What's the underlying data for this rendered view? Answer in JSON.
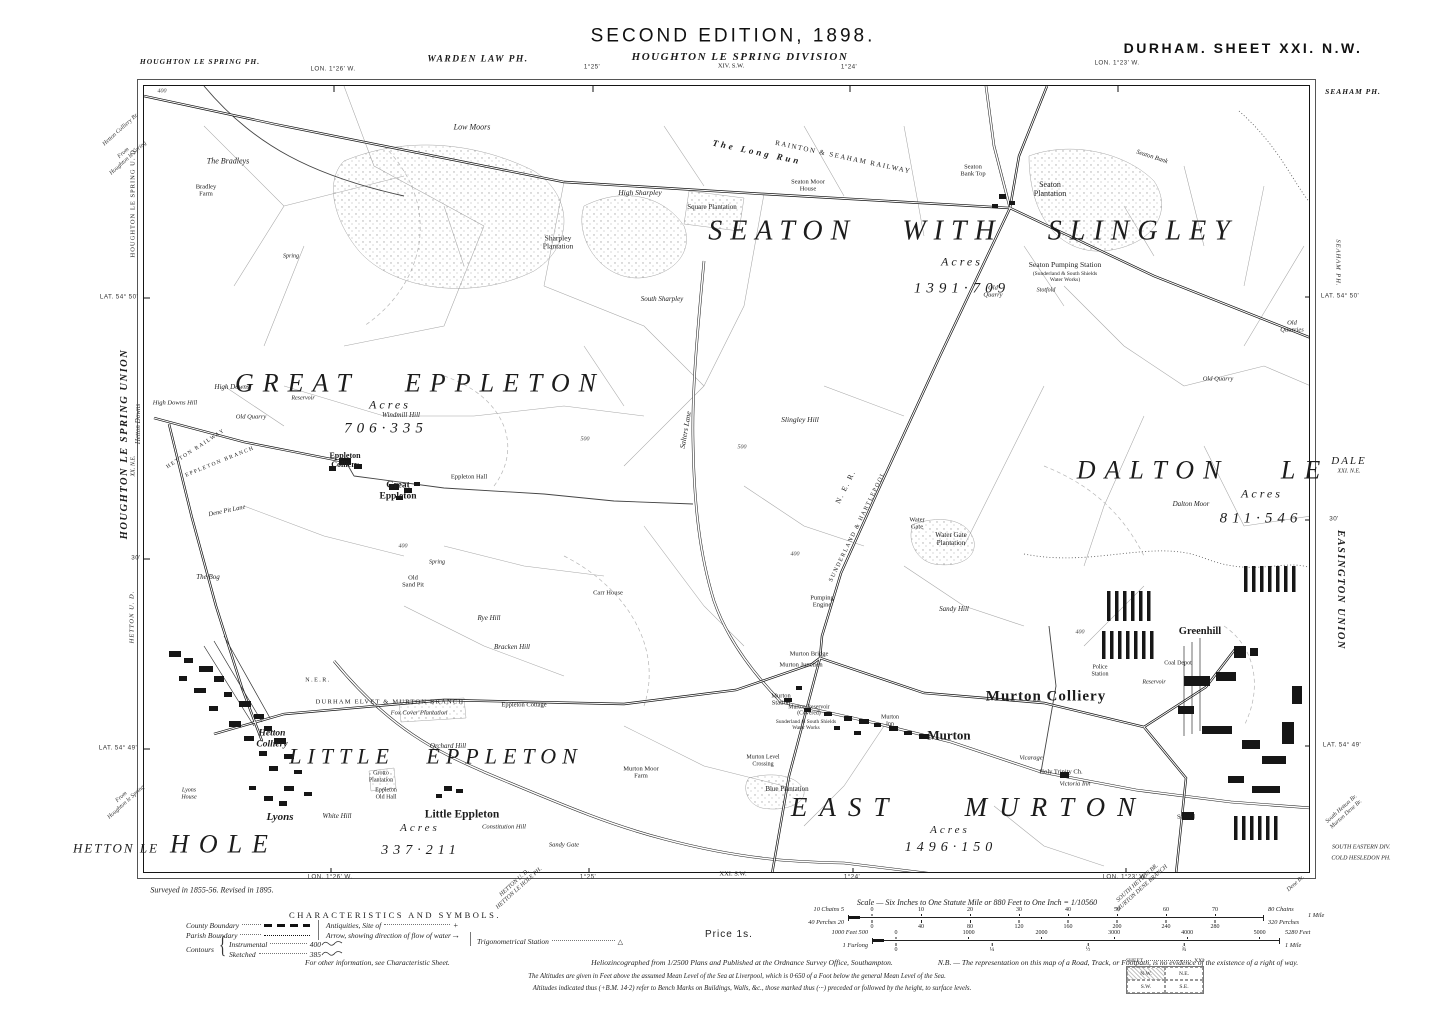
{
  "labels": [
    {
      "t": "SECOND EDITION, 1898.",
      "x": 733,
      "y": 36,
      "cls": "t1",
      "name": "edition-title"
    },
    {
      "t": "HOUGHTON LE SPRING DIVISION",
      "x": 740,
      "y": 57,
      "cls": "t2",
      "name": "division-title"
    },
    {
      "t": "XIV. S.W.",
      "x": 731,
      "y": 66,
      "cls": "t3",
      "name": "adjoining-sheet-north"
    },
    {
      "t": "DURHAM. SHEET XXI. N.W.",
      "x": 1243,
      "y": 49,
      "cls": "t4",
      "name": "sheet-title"
    },
    {
      "t": "HOUGHTON LE SPRING PH.",
      "x": 200,
      "y": 62,
      "cls": "par-s"
    },
    {
      "t": "WARDEN LAW PH.",
      "x": 478,
      "y": 60,
      "cls": "par"
    },
    {
      "t": "SEAHAM PH.",
      "x": 1353,
      "y": 92,
      "cls": "par-s"
    },
    {
      "t": "LON. 1°26' W.",
      "x": 333,
      "y": 69,
      "cls": "geo"
    },
    {
      "t": "1°25'",
      "x": 592,
      "y": 67,
      "cls": "geo"
    },
    {
      "t": "1°24'",
      "x": 849,
      "y": 67,
      "cls": "geo"
    },
    {
      "t": "LON. 1°23' W.",
      "x": 1117,
      "y": 63,
      "cls": "geo"
    },
    {
      "t": "LON. 1°26' W.",
      "x": 330,
      "y": 877,
      "cls": "geo"
    },
    {
      "t": "1°25'",
      "x": 588,
      "y": 877,
      "cls": "geo"
    },
    {
      "t": "XXI. S.W.",
      "x": 733,
      "y": 874,
      "cls": "t3",
      "name": "adjoining-sheet-south"
    },
    {
      "t": "1°24'",
      "x": 852,
      "y": 877,
      "cls": "geo"
    },
    {
      "t": "LON. 1°23' W.",
      "x": 1125,
      "y": 877,
      "cls": "geo"
    },
    {
      "t": "LAT. 54° 50'",
      "x": 119,
      "y": 297,
      "cls": "geo"
    },
    {
      "t": "30'",
      "x": 136,
      "y": 558,
      "cls": "geo"
    },
    {
      "t": "LAT. 54° 49'",
      "x": 118,
      "y": 748,
      "cls": "geo"
    },
    {
      "t": "LAT. 54° 50'",
      "x": 1340,
      "y": 296,
      "cls": "geo"
    },
    {
      "t": "30'",
      "x": 1334,
      "y": 519,
      "cls": "geo"
    },
    {
      "t": "LAT. 54° 49'",
      "x": 1342,
      "y": 745,
      "cls": "geo"
    },
    {
      "t": "Hetton Colliery Br.",
      "x": 121,
      "y": 130,
      "cls": "mar-it",
      "rot": -42
    },
    {
      "t": "From\nHoughton le Spring",
      "x": 126,
      "y": 156,
      "cls": "mar-it",
      "rot": -42
    },
    {
      "t": "HOUGHTON LE SPRING U. D.",
      "x": 133,
      "y": 202,
      "cls": "mar-s",
      "rot": -90
    },
    {
      "t": "HOUGHTON LE SPRING UNION",
      "x": 125,
      "y": 444,
      "cls": "mar-b",
      "rot": -90
    },
    {
      "t": "Hetton Downs",
      "x": 139,
      "y": 424,
      "cls": "mar-it",
      "rot": -90,
      "fs": 7
    },
    {
      "t": "XX. N.E.",
      "x": 134,
      "y": 466,
      "cls": "mar-xs",
      "rot": -90,
      "name": "adjoining-sheet-west"
    },
    {
      "t": "HETTON U. D.",
      "x": 132,
      "y": 617,
      "cls": "mar-si",
      "rot": -90
    },
    {
      "t": "From\nHoughton le Spring",
      "x": 124,
      "y": 800,
      "cls": "mar-it",
      "rot": -42
    },
    {
      "t": "HETTON LE",
      "x": 116,
      "y": 849,
      "cls": "giant",
      "fs": 13,
      "ls": 2,
      "name": "place-hetton-le-hole"
    },
    {
      "t": "SEAHAM PH.",
      "x": 1338,
      "y": 263,
      "cls": "mar-si",
      "rot": 90
    },
    {
      "t": "DALE",
      "x": 1349,
      "y": 461,
      "cls": "giant",
      "fs": 11,
      "ls": 2
    },
    {
      "t": "XXI. N.E.",
      "x": 1349,
      "y": 472,
      "cls": "mar-xs",
      "name": "adjoining-sheet-east"
    },
    {
      "t": "EASINGTON UNION",
      "x": 1340,
      "y": 590,
      "cls": "mar-b",
      "rot": 90
    },
    {
      "t": "South Hetton Br.\nMurton Dene Br.",
      "x": 1344,
      "y": 812,
      "cls": "mar-it",
      "rot": -42
    },
    {
      "t": "SOUTH EASTERN DIV.",
      "x": 1361,
      "y": 848,
      "cls": "mar-xs"
    },
    {
      "t": "COLD HESLEDON PH.",
      "x": 1361,
      "y": 859,
      "cls": "mar-xs"
    },
    {
      "t": "Surveyed in 1855-56. Revised in 1895.",
      "x": 212,
      "y": 891,
      "cls": "impr",
      "name": "survey-note"
    },
    {
      "t": "HETTON U. D.\nHETTON LE HOLE PH.",
      "x": 517,
      "y": 886,
      "cls": "mar-it",
      "rot": -42
    },
    {
      "t": "SOUTH HETTON BR.\nMURTON DENE BRANCH",
      "x": 1140,
      "y": 886,
      "cls": "mar-it",
      "rot": -42
    },
    {
      "t": "Dene Br.",
      "x": 1296,
      "y": 884,
      "cls": "mar-it",
      "rot": -42
    },
    {
      "t": "SEATON WITH SLINGLEY",
      "x": 973,
      "y": 231,
      "cls": "giant",
      "fs": 28,
      "ls": 8,
      "ws": 30,
      "name": "parish-seaton-with-slingley"
    },
    {
      "t": "Acres",
      "x": 962,
      "y": 262,
      "cls": "acres"
    },
    {
      "t": "1391·709",
      "x": 962,
      "y": 289,
      "cls": "acnum",
      "name": "acreage-seaton"
    },
    {
      "t": "GREAT EPPLETON",
      "x": 420,
      "y": 383,
      "cls": "giant",
      "fs": 26,
      "ls": 9,
      "ws": 30,
      "name": "parish-great-eppleton"
    },
    {
      "t": "Acres",
      "x": 390,
      "y": 405,
      "cls": "acres"
    },
    {
      "t": "706·335",
      "x": 386,
      "y": 429,
      "cls": "acnum",
      "name": "acreage-great-eppleton"
    },
    {
      "t": "DALTON LE",
      "x": 1203,
      "y": 470,
      "cls": "giant",
      "fs": 26,
      "ls": 9,
      "ws": 36,
      "name": "parish-dalton-le-dale"
    },
    {
      "t": "Acres",
      "x": 1262,
      "y": 494,
      "cls": "acres"
    },
    {
      "t": "811·546",
      "x": 1261,
      "y": 519,
      "cls": "acnum",
      "name": "acreage-dalton"
    },
    {
      "t": "LITTLE EPPLETON",
      "x": 436,
      "y": 757,
      "cls": "giant",
      "fs": 22,
      "ls": 6,
      "ws": 20,
      "name": "parish-little-eppleton"
    },
    {
      "t": "Acres",
      "x": 420,
      "y": 828,
      "cls": "acres",
      "fs": 11
    },
    {
      "t": "337·211",
      "x": 421,
      "y": 851,
      "cls": "acnum",
      "fs": 14,
      "name": "acreage-little-eppleton"
    },
    {
      "t": "EAST MURTON",
      "x": 969,
      "y": 807,
      "cls": "giant",
      "fs": 27,
      "ls": 12,
      "ws": 46,
      "name": "parish-east-murton"
    },
    {
      "t": "Acres",
      "x": 950,
      "y": 830,
      "cls": "acres",
      "fs": 11
    },
    {
      "t": "1496·150",
      "x": 951,
      "y": 848,
      "cls": "acnum",
      "fs": 14,
      "name": "acreage-east-murton"
    },
    {
      "t": "HOLE",
      "x": 224,
      "y": 844,
      "cls": "giant",
      "fs": 26,
      "ls": 10
    },
    {
      "t": "Murton Colliery",
      "x": 1046,
      "y": 697,
      "cls": "town",
      "fs": 15,
      "ls": 1,
      "name": "place-murton-colliery"
    },
    {
      "t": "Murton",
      "x": 949,
      "y": 736,
      "cls": "town",
      "fs": 13,
      "name": "place-murton"
    },
    {
      "t": "Little Eppleton",
      "x": 462,
      "y": 815,
      "cls": "town",
      "fs": 11.5,
      "name": "place-little-eppleton"
    },
    {
      "t": "Greenhill",
      "x": 1200,
      "y": 632,
      "cls": "town",
      "fs": 10.5,
      "name": "place-greenhill"
    },
    {
      "t": "Hetton\nColliery",
      "x": 272,
      "y": 739,
      "cls": "pl-it",
      "fs": 9.5,
      "name": "place-hetton-colliery"
    },
    {
      "t": "Lyons",
      "x": 280,
      "y": 817,
      "cls": "pl-it",
      "fs": 11,
      "name": "place-lyons"
    },
    {
      "t": "Great\nEppleton",
      "x": 398,
      "y": 491,
      "cls": "vil",
      "fs": 9.5
    },
    {
      "t": "Eppleton\nColliery",
      "x": 345,
      "y": 461,
      "cls": "vil",
      "fs": 8
    },
    {
      "t": "RAINTON & SEAHAM RAILWAY",
      "x": 843,
      "y": 158,
      "cls": "rail",
      "rot": 12,
      "fs": 7,
      "name": "railway-rainton-seaham"
    },
    {
      "t": "The Long Run",
      "x": 757,
      "y": 152,
      "cls": "pl-it",
      "rot": 12,
      "fs": 9,
      "ls": 3
    },
    {
      "t": "N. E. R.",
      "x": 846,
      "y": 487,
      "cls": "rail",
      "rot": -64,
      "fs": 7.5
    },
    {
      "t": "SUNDERLAND & HARTLEPOOL",
      "x": 858,
      "y": 527,
      "cls": "rail",
      "rot": -64,
      "fs": 6,
      "name": "railway-sunderland-hartlepool"
    },
    {
      "t": "N.E.R.",
      "x": 318,
      "y": 681,
      "cls": "rail",
      "fs": 6
    },
    {
      "t": "DURHAM ELVET & MURTON BRANCH",
      "x": 390,
      "y": 702,
      "cls": "rail",
      "fs": 6.5,
      "ls": 1.2,
      "name": "railway-durham-elvet-murton"
    },
    {
      "t": "HETTON RAILWAY",
      "x": 196,
      "y": 449,
      "cls": "rail",
      "fs": 5.5,
      "rot": -33
    },
    {
      "t": "EPPLETON BRANCH",
      "x": 220,
      "y": 462,
      "cls": "rail",
      "fs": 5.5,
      "rot": -22
    },
    {
      "t": "Low Moors",
      "x": 472,
      "y": 128,
      "cls": "smi",
      "fs": 8
    },
    {
      "t": "The Bradleys",
      "x": 228,
      "y": 162,
      "cls": "smi",
      "fs": 8
    },
    {
      "t": "Bradley\nFarm",
      "x": 206,
      "y": 191,
      "cls": "xs",
      "fs": 6.5
    },
    {
      "t": "High Sharpley",
      "x": 640,
      "y": 193,
      "cls": "smi",
      "fs": 7.5
    },
    {
      "t": "Sharpley\nPlantation",
      "x": 558,
      "y": 243,
      "cls": "sm",
      "fs": 7.5
    },
    {
      "t": "South Sharpley",
      "x": 662,
      "y": 300,
      "cls": "smi",
      "fs": 7
    },
    {
      "t": "Square Plantation",
      "x": 712,
      "y": 208,
      "cls": "sm",
      "fs": 7
    },
    {
      "t": "Seaton Moor\nHouse",
      "x": 808,
      "y": 186,
      "cls": "xs",
      "fs": 6.5
    },
    {
      "t": "Seaton\nBank Top",
      "x": 973,
      "y": 171,
      "cls": "xs",
      "fs": 6.5
    },
    {
      "t": "Seaton\nPlantation",
      "x": 1050,
      "y": 190,
      "cls": "sm",
      "fs": 8
    },
    {
      "t": "Seaton Bank",
      "x": 1152,
      "y": 157,
      "cls": "smi",
      "fs": 6.5,
      "rot": 18
    },
    {
      "t": "Seaton Pumping Station",
      "x": 1065,
      "y": 265,
      "cls": "sm",
      "fs": 7.5
    },
    {
      "t": "(Sunderland & South Shields\nWater Works)",
      "x": 1065,
      "y": 277,
      "cls": "xs",
      "fs": 5.5
    },
    {
      "t": "Stotfold",
      "x": 1046,
      "y": 291,
      "cls": "xsi",
      "fs": 6
    },
    {
      "t": "Old\nQuarry",
      "x": 993,
      "y": 292,
      "cls": "xsi",
      "fs": 6.5
    },
    {
      "t": "Spring",
      "x": 291,
      "y": 257,
      "cls": "xsi",
      "fs": 6
    },
    {
      "t": "High Downs",
      "x": 232,
      "y": 388,
      "cls": "smi",
      "fs": 7
    },
    {
      "t": "High Downs Hill",
      "x": 175,
      "y": 403,
      "cls": "xsi",
      "fs": 6.5
    },
    {
      "t": "Old Quarry",
      "x": 251,
      "y": 417,
      "cls": "xsi",
      "fs": 6.5
    },
    {
      "t": "Reservoir",
      "x": 303,
      "y": 399,
      "cls": "xsi",
      "fs": 6
    },
    {
      "t": "Windmill Hill",
      "x": 401,
      "y": 416,
      "cls": "smi",
      "fs": 7
    },
    {
      "t": "Eppleton Hall",
      "x": 469,
      "y": 477,
      "cls": "xs",
      "fs": 6.5
    },
    {
      "t": "Salters Lane",
      "x": 686,
      "y": 430,
      "cls": "smi",
      "fs": 7.5,
      "rot": -80
    },
    {
      "t": "Slingley Hill",
      "x": 800,
      "y": 420,
      "cls": "smi",
      "fs": 7.5
    },
    {
      "t": "Dalton Moor",
      "x": 1191,
      "y": 505,
      "cls": "smi",
      "fs": 7
    },
    {
      "t": "Old Quarry",
      "x": 1218,
      "y": 379,
      "cls": "xsi",
      "fs": 6.5
    },
    {
      "t": "Old\nQuarries",
      "x": 1292,
      "y": 327,
      "cls": "xsi",
      "fs": 6.5
    },
    {
      "t": "Dene Pit Lane",
      "x": 227,
      "y": 511,
      "cls": "smi",
      "fs": 6.5,
      "rot": -12
    },
    {
      "t": "The Bog",
      "x": 208,
      "y": 578,
      "cls": "smi",
      "fs": 7
    },
    {
      "t": "Spring",
      "x": 437,
      "y": 563,
      "cls": "xsi",
      "fs": 6
    },
    {
      "t": "Old\nSand Pit",
      "x": 413,
      "y": 582,
      "cls": "xs",
      "fs": 6.5
    },
    {
      "t": "Carr House",
      "x": 608,
      "y": 593,
      "cls": "xs",
      "fs": 6.5
    },
    {
      "t": "Rye Hill",
      "x": 489,
      "y": 619,
      "cls": "smi",
      "fs": 7
    },
    {
      "t": "Bracken Hill",
      "x": 512,
      "y": 648,
      "cls": "smi",
      "fs": 7
    },
    {
      "t": "Water\nGate",
      "x": 917,
      "y": 524,
      "cls": "xs",
      "fs": 6.5
    },
    {
      "t": "Water Gate\nPlantation",
      "x": 951,
      "y": 540,
      "cls": "sm",
      "fs": 7
    },
    {
      "t": "Pumping\nEngine",
      "x": 822,
      "y": 602,
      "cls": "xs",
      "fs": 6.5
    },
    {
      "t": "Sandy Hill",
      "x": 954,
      "y": 610,
      "cls": "smi",
      "fs": 7
    },
    {
      "t": "400",
      "x": 162,
      "y": 92,
      "cls": "num"
    },
    {
      "t": "500",
      "x": 585,
      "y": 440,
      "cls": "num"
    },
    {
      "t": "500",
      "x": 742,
      "y": 448,
      "cls": "num"
    },
    {
      "t": "400",
      "x": 403,
      "y": 547,
      "cls": "num"
    },
    {
      "t": "400",
      "x": 795,
      "y": 555,
      "cls": "num"
    },
    {
      "t": "400",
      "x": 1080,
      "y": 633,
      "cls": "num"
    },
    {
      "t": "Murton Bridge",
      "x": 809,
      "y": 654,
      "cls": "xs",
      "fs": 6.5
    },
    {
      "t": "Murton Junction",
      "x": 801,
      "y": 665,
      "cls": "xs",
      "fs": 6.5
    },
    {
      "t": "Murton\nStation",
      "x": 781,
      "y": 700,
      "cls": "xs",
      "fs": 6.5
    },
    {
      "t": "Murton Reservoir\n(Covered)",
      "x": 809,
      "y": 711,
      "cls": "xs",
      "fs": 5.8
    },
    {
      "t": "Sunderland & South Shields\nWater Works",
      "x": 806,
      "y": 726,
      "cls": "xs",
      "fs": 5.3
    },
    {
      "t": "Murton Level\nCrossing",
      "x": 763,
      "y": 761,
      "cls": "xs",
      "fs": 6
    },
    {
      "t": "Murton\nInn",
      "x": 890,
      "y": 721,
      "cls": "xs",
      "fs": 6
    },
    {
      "t": "Vicarage",
      "x": 1031,
      "y": 758,
      "cls": "xsi",
      "fs": 6.5
    },
    {
      "t": "Holy Trinity Ch.",
      "x": 1061,
      "y": 772,
      "cls": "xs",
      "fs": 6.5
    },
    {
      "t": "Victoria Inn",
      "x": 1075,
      "y": 784,
      "cls": "xsi",
      "fs": 6.5
    },
    {
      "t": "Blue Plantation",
      "x": 787,
      "y": 790,
      "cls": "sm",
      "fs": 7
    },
    {
      "t": "Police\nStation",
      "x": 1100,
      "y": 671,
      "cls": "xs",
      "fs": 6
    },
    {
      "t": "Coal Depot",
      "x": 1178,
      "y": 664,
      "cls": "xs",
      "fs": 6
    },
    {
      "t": "Reservoir",
      "x": 1154,
      "y": 683,
      "cls": "xsi",
      "fs": 6
    },
    {
      "t": "School",
      "x": 1186,
      "y": 817,
      "cls": "xs",
      "fs": 6.5
    },
    {
      "t": "Fox Cover Plantation",
      "x": 419,
      "y": 713,
      "cls": "smi",
      "fs": 6.5
    },
    {
      "t": "Eppleton Cottage",
      "x": 524,
      "y": 705,
      "cls": "xs",
      "fs": 6.5
    },
    {
      "t": "Orchard Hill",
      "x": 448,
      "y": 747,
      "cls": "smi",
      "fs": 7
    },
    {
      "t": "Grotto\nPlantation",
      "x": 381,
      "y": 777,
      "cls": "xs",
      "fs": 6
    },
    {
      "t": "Eppleton\nOld Hall",
      "x": 386,
      "y": 794,
      "cls": "xs",
      "fs": 6
    },
    {
      "t": "White Hill",
      "x": 337,
      "y": 817,
      "cls": "smi",
      "fs": 7
    },
    {
      "t": "Constitution Hill",
      "x": 504,
      "y": 827,
      "cls": "smi",
      "fs": 6.5
    },
    {
      "t": "Sandy Gate",
      "x": 564,
      "y": 845,
      "cls": "smi",
      "fs": 6.5
    },
    {
      "t": "Lyons\nHouse",
      "x": 189,
      "y": 794,
      "cls": "xsi",
      "fs": 6
    },
    {
      "t": "Murton Moor\nFarm",
      "x": 641,
      "y": 773,
      "cls": "xs",
      "fs": 6.5
    }
  ],
  "legend": {
    "title": "CHARACTERISTICS AND SYMBOLS.",
    "county": "County Boundary",
    "parish": "Parish Boundary",
    "contours": "Contours",
    "instrumental": "Instrumental",
    "instrumental_value": "400",
    "sketched": "Sketched",
    "sketched_value": "385",
    "antiquities": "Antiquities, Site of",
    "antiquities_symbol": "+",
    "arrow": "Arrow, showing direction of flow of water",
    "arrow_symbol": "→",
    "trig": "Trigonometrical Station",
    "trig_symbol": "△",
    "more_info": "For other information, see Characteristic Sheet."
  },
  "scale": {
    "title": "Scale — Six Inches to One Statute Mile or 880 Feet to One Inch = 1/10560",
    "price": "Price 1s.",
    "chains_left": "10 Chains 5",
    "chains_ticks": [
      {
        "v": "0",
        "p": 0
      },
      {
        "v": "10",
        "p": 0.125
      },
      {
        "v": "20",
        "p": 0.25
      },
      {
        "v": "30",
        "p": 0.375
      },
      {
        "v": "40",
        "p": 0.5
      },
      {
        "v": "50",
        "p": 0.625
      },
      {
        "v": "60",
        "p": 0.75
      },
      {
        "v": "70",
        "p": 0.875
      }
    ],
    "chains_right": "80 Chains",
    "perches_left": "40 Perches 20",
    "perches_ticks": [
      {
        "v": "0",
        "p": 0
      },
      {
        "v": "40",
        "p": 0.125
      },
      {
        "v": "80",
        "p": 0.25
      },
      {
        "v": "120",
        "p": 0.375
      },
      {
        "v": "160",
        "p": 0.5
      },
      {
        "v": "200",
        "p": 0.625
      },
      {
        "v": "240",
        "p": 0.75
      },
      {
        "v": "280",
        "p": 0.875
      }
    ],
    "perches_right": "320 Perches",
    "mile_right": "1 Mile",
    "feet_left": "1000 Feet 500",
    "feet_ticks": [
      {
        "v": "0",
        "p": 0
      },
      {
        "v": "1000",
        "p": 0.189
      },
      {
        "v": "2000",
        "p": 0.379
      },
      {
        "v": "3000",
        "p": 0.568
      },
      {
        "v": "4000",
        "p": 0.758
      },
      {
        "v": "5000",
        "p": 0.947
      }
    ],
    "feet_right": "5280 Feet",
    "furlong_left": "1 Furlong",
    "furlong_ticks": [
      {
        "v": "0",
        "p": 0
      },
      {
        "v": "¼",
        "p": 0.25
      },
      {
        "v": "½",
        "p": 0.5
      },
      {
        "v": "¾",
        "p": 0.75
      }
    ],
    "furlong_right": "1 Mile"
  },
  "imprint": {
    "publisher": "Heliozincographed from 1/2500 Plans and Published at the Ordnance Survey Office, Southampton.",
    "nb": "N.B. — The representation on this map of a Road, Track, or Footpath, is no evidence of the existence of a right of way.",
    "altitude_note": "The Altitudes are given in Feet above the assumed Mean Level of the Sea at Liverpool, which is 0·650 of a Foot below the general Mean Level of the Sea.",
    "benchmark_note": "Altitudes indicated thus (+B.M. 14·2) refer to Bench Marks on Buildings, Walls, &c., those marked thus (···) preceded or followed by the height, to surface levels."
  },
  "sheet_index": {
    "label": "SHEET",
    "number": "XXI",
    "cells": [
      "N.W.",
      "N.E.",
      "S.W.",
      "S.E."
    ],
    "highlighted": "N.W."
  }
}
